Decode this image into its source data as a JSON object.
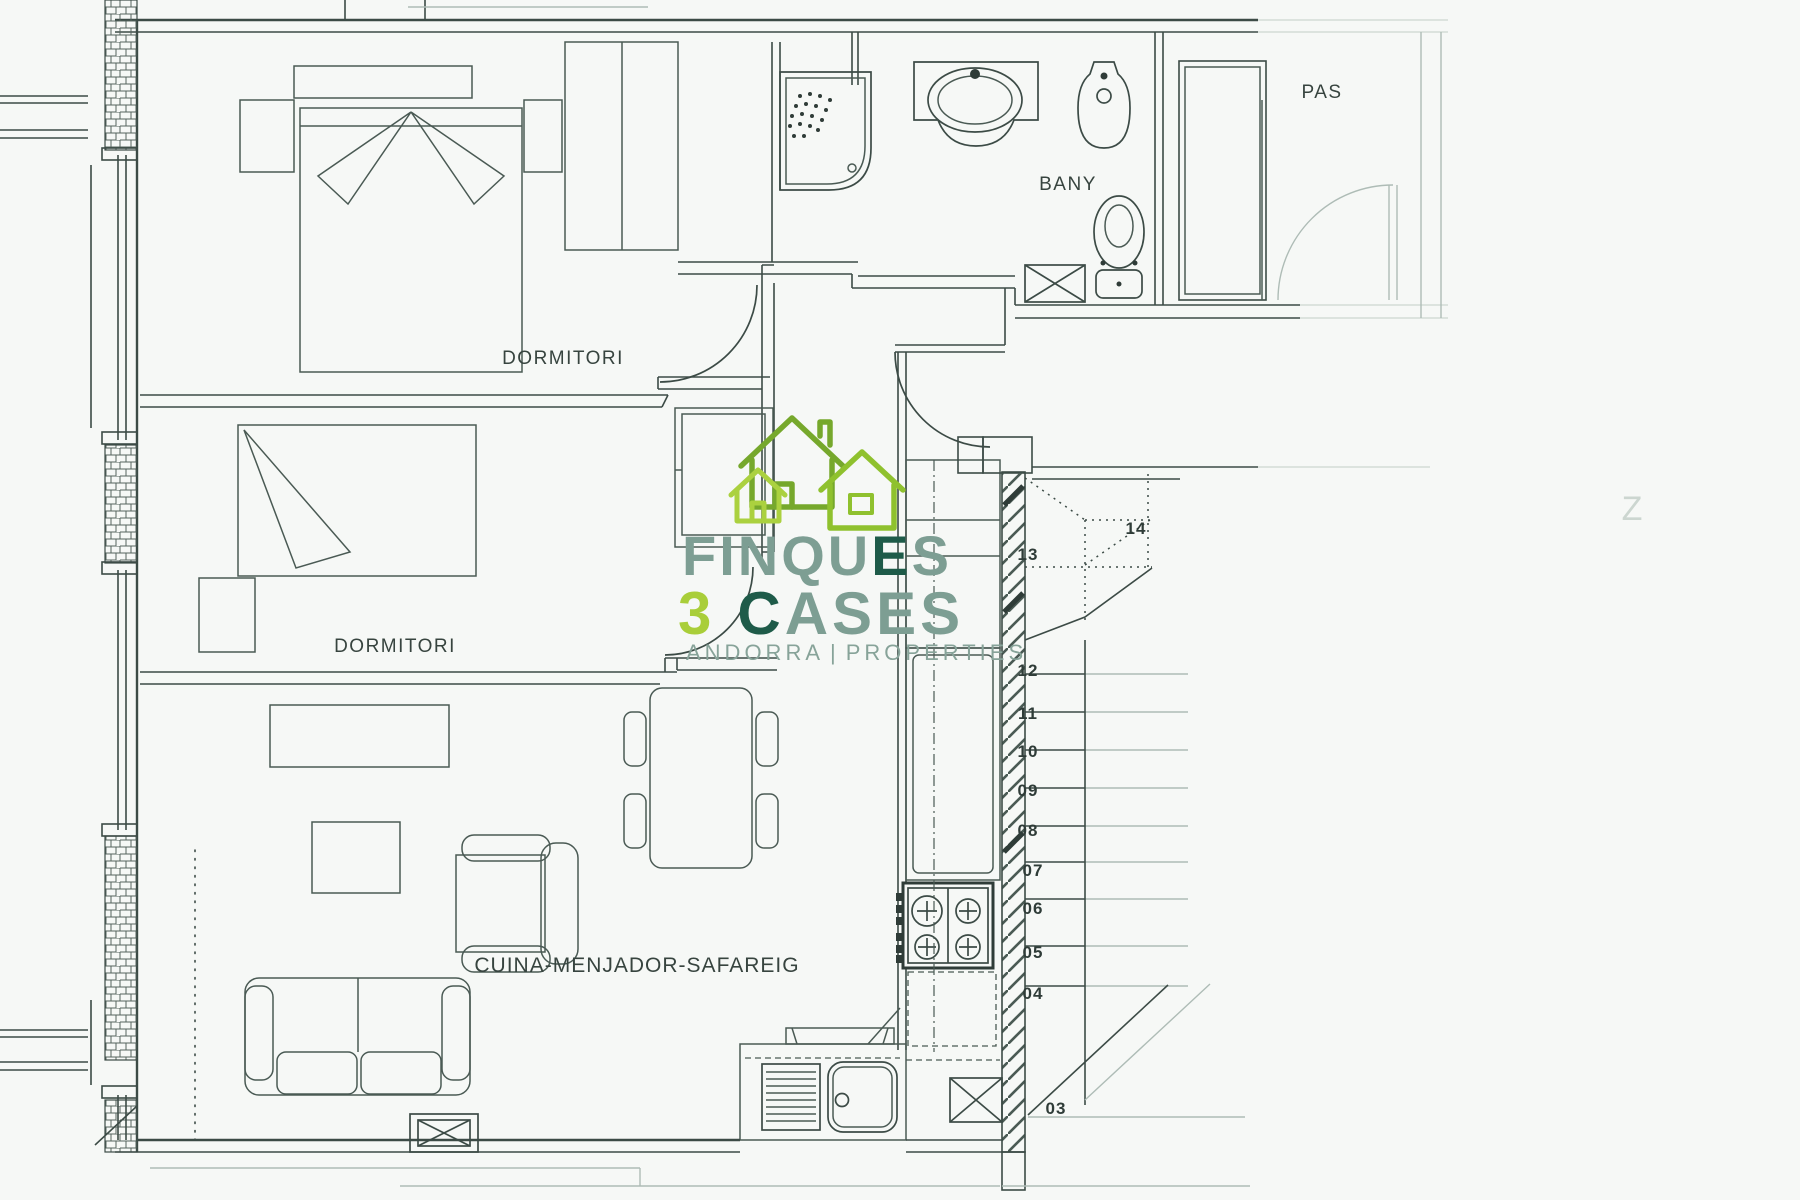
{
  "plan": {
    "rooms": {
      "bedroom1": "DORMITORI",
      "bedroom2": "DORMITORI",
      "bathroom": "BANY",
      "corridor": "PAS",
      "living": "CUINA-MENJADOR-SAFAREIG"
    },
    "stairs": {
      "numbers": [
        "14",
        "13",
        "12",
        "11",
        "10",
        "09",
        "08",
        "07",
        "06",
        "05",
        "04",
        "03"
      ]
    },
    "artifact": "Z"
  },
  "logo": {
    "brand_top_a": "FINQU",
    "brand_top_b": "E",
    "brand_top_c": "S",
    "brand_num": "3",
    "brand_c": "C",
    "brand_rest": "ASES",
    "tagline_left": "ANDORRA",
    "tagline_sep": "|",
    "tagline_right": "PROPERTIES",
    "colors": {
      "sage": "#7d9e93",
      "dark_green": "#1e5b49",
      "lime": "#a9ce39",
      "house_olive": "#76a82c",
      "house_mid": "#8fc12e",
      "house_light": "#abd13f"
    }
  }
}
